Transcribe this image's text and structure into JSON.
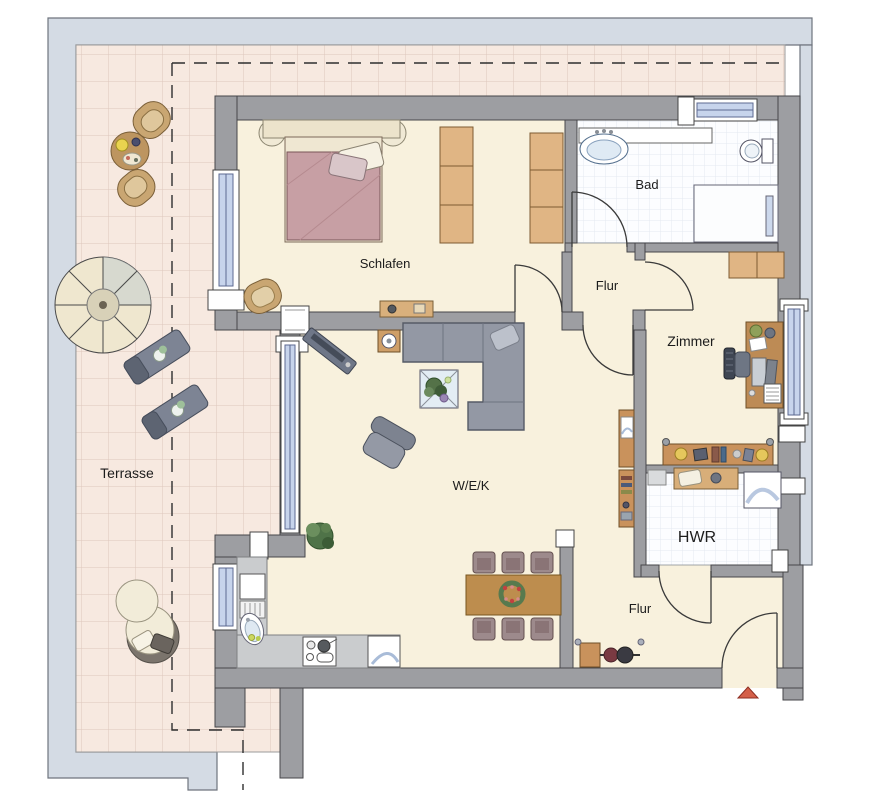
{
  "plan": {
    "type": "apartment-floor-plan",
    "labels": {
      "terrasse": "Terrasse",
      "schlafen": "Schlafen",
      "bad": "Bad",
      "flur_oben": "Flur",
      "zimmer": "Zimmer",
      "wek": "W/E/K",
      "hwr": "HWR",
      "flur_unten": "Flur"
    },
    "colors": {
      "pavement": "#d4dbe4",
      "terrace_tile": "#f7e9e0",
      "floor": "#f8f1dd",
      "wall": "#9d9ea2",
      "tile_room": "#fcfdff",
      "window_glass": "#c7d4ec",
      "bed_blanket": "#c79fa4",
      "sofa": "#9398a4",
      "wood": "#c9925c",
      "lounger": "#7d8494",
      "entrance_arrow": "#d4604a"
    },
    "furniture": {
      "terrasse": [
        "tub-chair",
        "round-table",
        "tub-chair",
        "parasol",
        "sun-lounger",
        "sun-lounger",
        "round-daybed"
      ],
      "schlafen": [
        "double-bed",
        "nightstand",
        "nightstand",
        "wardrobe",
        "wardrobe",
        "armchair",
        "bench"
      ],
      "bad": [
        "washbasin-counter",
        "toilet",
        "shower"
      ],
      "zimmer": [
        "shelf",
        "desk",
        "office-chair",
        "sideboard"
      ],
      "wek": [
        "tv-bench",
        "side-table",
        "corner-sofa",
        "coffee-table",
        "armchair",
        "plant",
        "dining-table",
        "six-chairs",
        "kitchen-counter",
        "fridge",
        "sink",
        "stove",
        "dishwasher",
        "bookshelf"
      ],
      "hwr": [
        "washing-machine",
        "bench"
      ],
      "flur_unten": [
        "coat-rack"
      ],
      "entrance": [
        "entrance-arrow"
      ]
    }
  }
}
